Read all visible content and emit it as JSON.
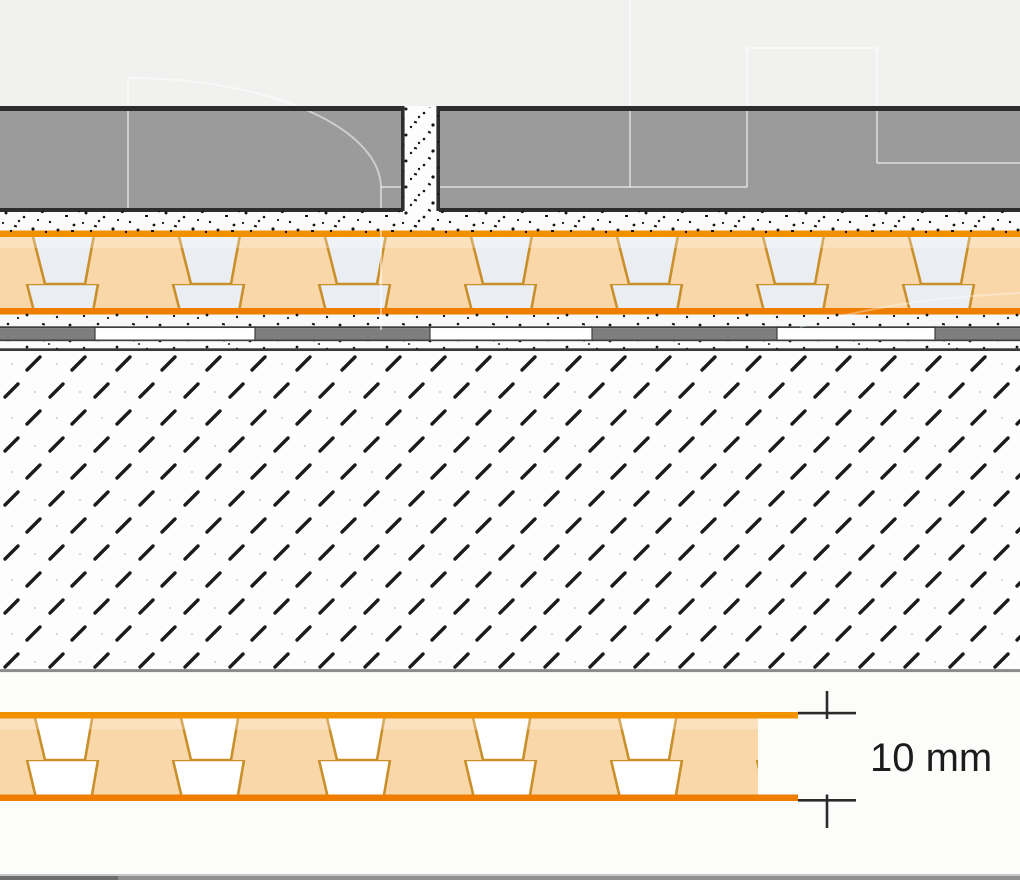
{
  "dimension": {
    "label": "10 mm"
  },
  "colors": {
    "background_top": "#F1F1F0",
    "background_bottom": "#FCFCFB",
    "hatch_area_bg": "#FDFDFD",
    "tile_gray": "#9B9B9B",
    "outline_dark": "#2D2D2D",
    "joint_white": "#FDFDFD",
    "mortar_white": "#FBFBFB",
    "speckle_dot": "#151515",
    "membrane_orange": "#F29100",
    "membrane_orange_deep": "#EF7D00",
    "membrane_web": "#C98F2B",
    "membrane_fill": "#FAD7A8",
    "membrane_cavity_top": "#EAEEF3",
    "membrane_cavity_bottom": "#FFFFFF",
    "underlay_band": "#F6F8FA",
    "strip_gray": "#7E7E7E",
    "strip_white": "#FFFFFF",
    "strip_edge": "#3F3F3F",
    "screed_boundary": "#383838",
    "hatch_dash": "#1B1B1B",
    "hatch_dot": "#CCCCCC",
    "substrate_line": "#8B8B8B",
    "dimension_line": "#2B2B2B",
    "label_text": "#1C1C1C",
    "watermark": "#FFFFFF",
    "bottom_bar_light_edge": "#C7C7C7",
    "bottom_bar_left": "#6E6E6E",
    "bottom_bar_right": "#909090"
  }
}
